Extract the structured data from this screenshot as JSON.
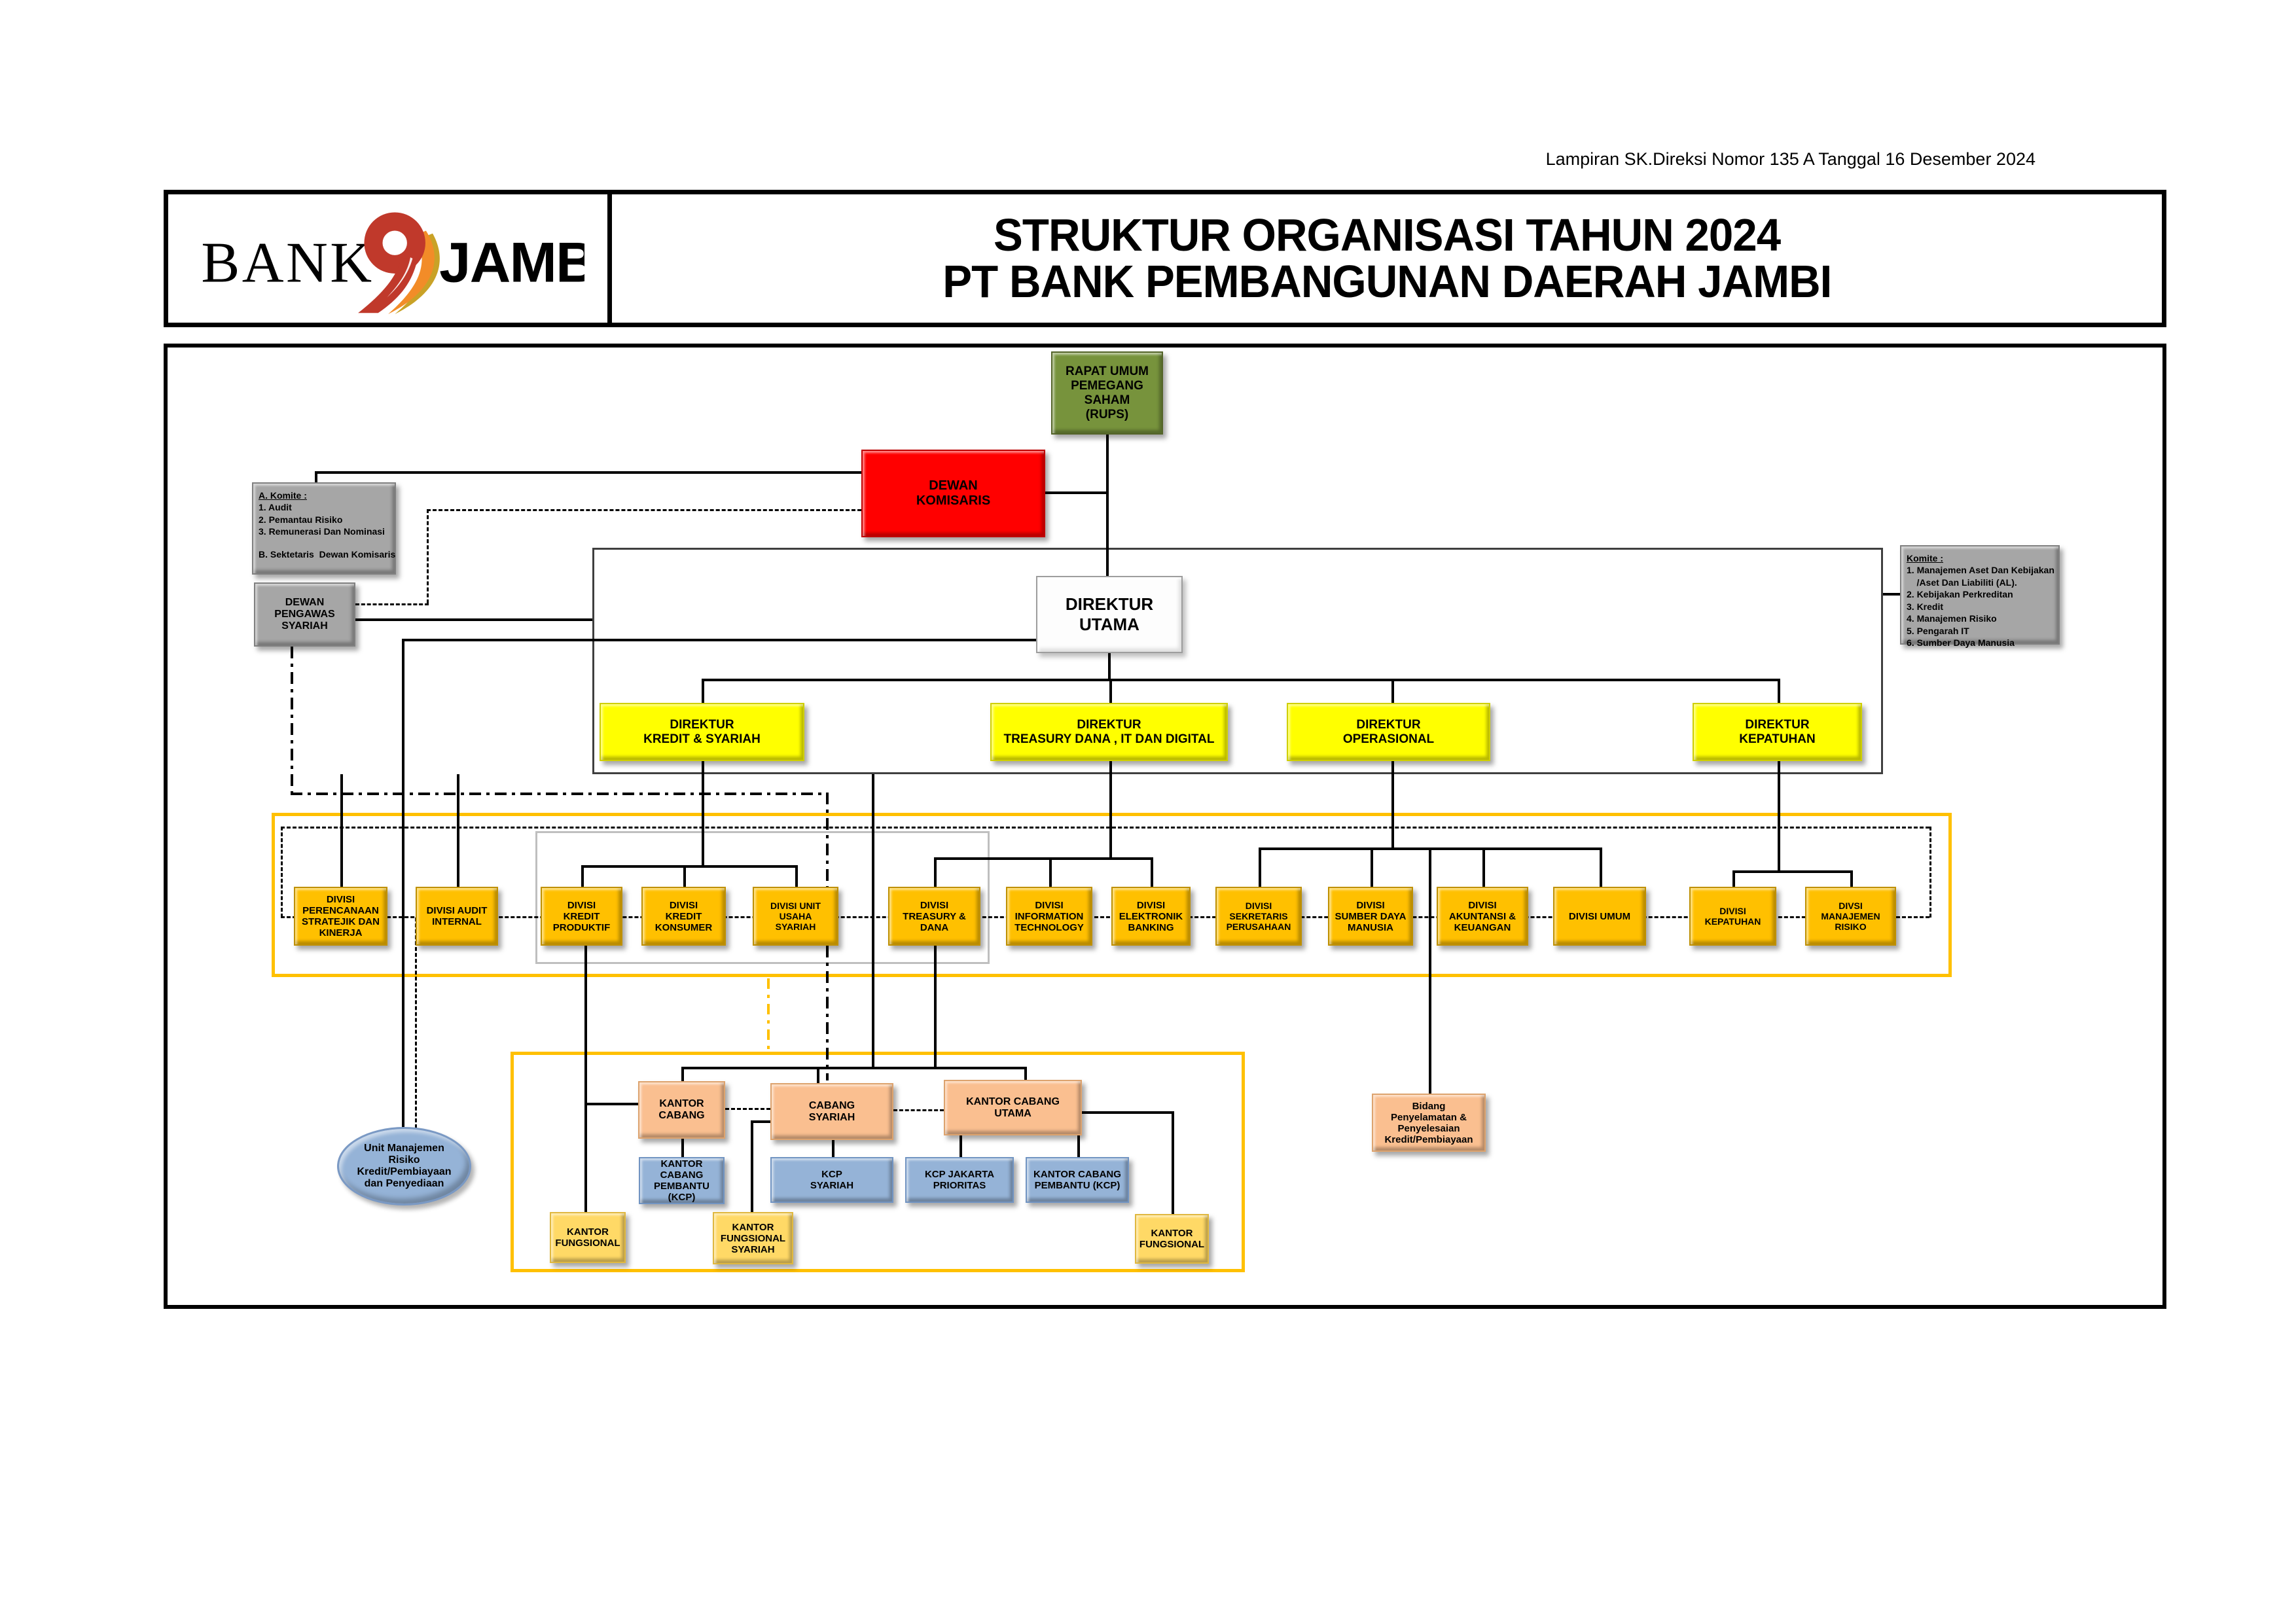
{
  "meta": {
    "lampiran": "Lampiran SK.Direksi Nomor  135 A  Tanggal 16 Desember 2024"
  },
  "header": {
    "logo": {
      "bank": "BANK",
      "jambi": "JAMBI"
    },
    "title_line1": "STRUKTUR ORGANISASI TAHUN 2024",
    "title_line2": "PT BANK PEMBANGUNAN DAERAH JAMBI"
  },
  "nodes": {
    "rups": "RAPAT UMUM\nPEMEGANG SAHAM\n(RUPS)",
    "dewan_komisaris": "DEWAN\nKOMISARIS",
    "dewan_pengawas_syariah": "DEWAN PENGAWAS\nSYARIAH",
    "direktur_utama": "DIREKTUR UTAMA",
    "komite_a": {
      "lines": [
        "A. Komite :",
        "1. Audit",
        "2. Pemantau Risiko",
        "3. Remunerasi Dan Nominasi",
        "B. Sektetaris  Dewan Komisaris"
      ]
    },
    "komite_b": {
      "lines": [
        "Komite :",
        "1. Manajemen Aset Dan Kebijakan",
        "    /Aset Dan Liabiliti (AL).",
        "2. Kebijakan Perkreditan",
        "3. Kredit",
        "4. Manajemen Risiko",
        "5. Pengarah IT",
        "6. Sumber Daya Manusia"
      ]
    },
    "direktur": [
      "DIREKTUR\nKREDIT & SYARIAH",
      "DIREKTUR\nTREASURY DANA , IT DAN DIGITAL",
      "DIREKTUR\nOPERASIONAL",
      "DIREKTUR\nKEPATUHAN"
    ],
    "divisi": [
      "DIVISI\nPERENCANAAN\nSTRATEJIK DAN\nKINERJA",
      "DIVISI AUDIT\nINTERNAL",
      "DIVISI\nKREDIT\nPRODUKTIF",
      "DIVISI\nKREDIT\nKONSUMER",
      "DIVISI UNIT USAHA\nSYARIAH",
      "DIVISI\nTREASURY & DANA",
      "DIVISI\nINFORMATION\nTECHNOLOGY",
      "DIVISI\nELEKTRONIK\nBANKING",
      "DIVISI SEKRETARIS\nPERUSAHAAN",
      "DIVISI\nSUMBER DAYA\nMANUSIA",
      "DIVISI\nAKUNTANSI &\nKEUANGAN",
      "DIVISI UMUM",
      "DIVISI KEPATUHAN",
      "DIVSI\nMANAJEMEN RISIKO"
    ],
    "offices": {
      "kantor_cabang": "KANTOR CABANG",
      "cabang_syariah": "CABANG\nSYARIAH",
      "kantor_cabang_utama": "KANTOR CABANG\nUTAMA",
      "kcp_1": "KANTOR CABANG\nPEMBANTU (KCP)",
      "kcp_syariah": "KCP\nSYARIAH",
      "kcp_jakarta": "KCP JAKARTA\nPRIORITAS",
      "kcp_2": "KANTOR CABANG\nPEMBANTU (KCP)",
      "kantor_fungsional_1": "KANTOR\nFUNGSIONAL",
      "kantor_fungsional_syariah": "KANTOR\nFUNGSIONAL\nSYARIAH",
      "kantor_fungsional_2": "KANTOR\nFUNGSIONAL"
    },
    "bidang_penyelamatan": "Bidang\nPenyelamatan &\nPenyelesaian\nKredit/Pembiayaan",
    "unit_manajemen_risiko": "Unit Manajemen\nRisiko\nKredit/Pembiayaan\ndan Penyediaan"
  },
  "colors": {
    "rups_green": "#77933C",
    "komisaris_red": "#FF0000",
    "committee_gray": "#A6A6A6",
    "direktur_yellow": "#FFFF00",
    "divisi_gold": "#FFC000",
    "branch_peach": "#FABF90",
    "kcp_blue": "#95B3D7",
    "fungsional_yellow": "#FFD966",
    "frame_amber": "#FFC000",
    "logo_red": "#C0392B",
    "logo_orange": "#F28C28"
  }
}
